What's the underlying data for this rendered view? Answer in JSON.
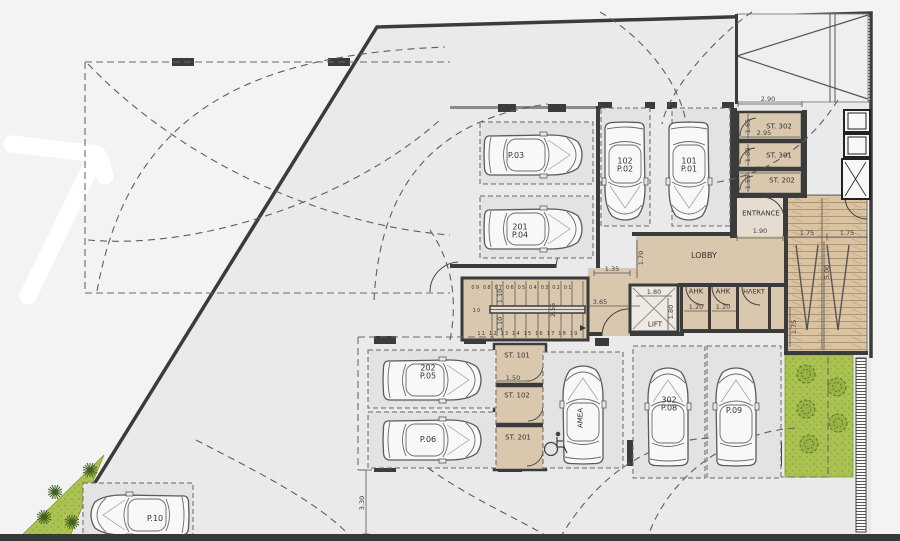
{
  "plan": {
    "rooms": {
      "lobby": "LOBBY",
      "entrance": "ENTRANCE",
      "lift": "LIFT",
      "ahk_left": "AHK",
      "ahk_right": "AHK",
      "electrical": "ΗΛΕΚΤ"
    },
    "storage": {
      "st302": "ST. 302",
      "st301": "ST. 301",
      "st202": "ST. 202",
      "st101": "ST. 101",
      "st102": "ST. 102",
      "st201": "ST. 201"
    },
    "parking": {
      "p03": "P.03",
      "p04_unit": "201",
      "p04": "P.04",
      "p02_unit": "102",
      "p02": "P.02",
      "p01_unit": "101",
      "p01": "P.01",
      "p05_unit": "202",
      "p05": "P.05",
      "p06": "P.06",
      "p08_unit": "302",
      "p08": "P.08",
      "p09": "P.09",
      "p10": "P.10",
      "amea": "AMEA"
    },
    "stairs": {
      "upper_steps": "09 08 07 06 05 04 03 02 01",
      "lower_steps": "11 12 13 14 15 16 17 18 19",
      "landing": "10"
    },
    "dims": {
      "d290": "2.90",
      "d295a": "2.95",
      "d295b": "2.95",
      "d165": "1.65",
      "d180st": "1.80",
      "d155": "1.55",
      "d190": "1.90",
      "d175a": "1.75",
      "d175b": "1.75",
      "d500": "5.00",
      "d175c": "1.75",
      "d135": "1.35",
      "d170": "1.70",
      "d365": "3.65",
      "d255": "2.55",
      "d110a": "1.10",
      "d110b": "1.10",
      "d180a": "1.80",
      "d180b": "1.80",
      "d120a": "1.20",
      "d120b": "1.20",
      "d150": "1.50",
      "d330": "3.30"
    },
    "colors": {
      "circulation_tan": "#d9c7ae",
      "wall": "#3b3b3b",
      "landscape_green": "#a9c24c",
      "ramp_wood": "#d9c3a3"
    }
  }
}
